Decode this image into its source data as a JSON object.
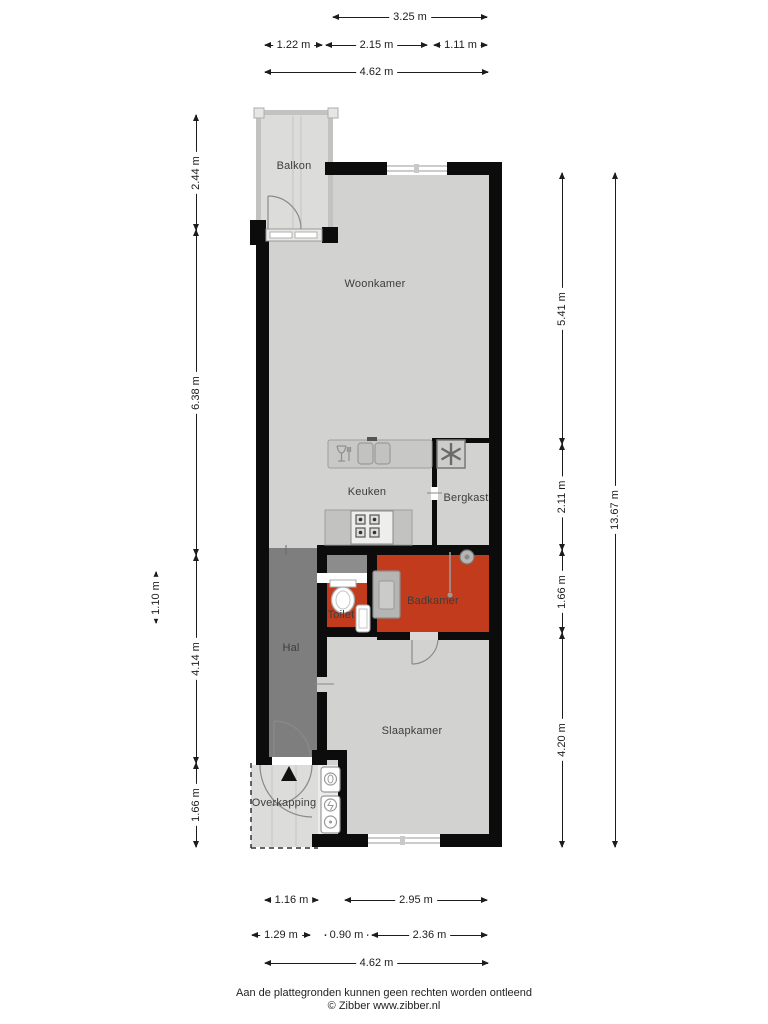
{
  "floorplan": {
    "colors": {
      "wall": "#0c0c0c",
      "floor_indoor": "#d2d2d0",
      "floor_outdoor": "#dcdcda",
      "floor_hall": "#7e7e7e",
      "floor_wet_room": "#c33b1d",
      "counter": "#c8c8c6"
    },
    "rooms": [
      {
        "id": "balkon",
        "label": "Balkon",
        "cx": 294,
        "cy": 166
      },
      {
        "id": "woonkamer",
        "label": "Woonkamer",
        "cx": 375,
        "cy": 284
      },
      {
        "id": "keuken",
        "label": "Keuken",
        "cx": 367,
        "cy": 492
      },
      {
        "id": "bergkast",
        "label": "Bergkast",
        "cx": 466,
        "cy": 498
      },
      {
        "id": "toilet",
        "label": "Toilet",
        "cx": 341,
        "cy": 615
      },
      {
        "id": "badkamer",
        "label": "Badkamer",
        "cx": 433,
        "cy": 601
      },
      {
        "id": "hal",
        "label": "Hal",
        "cx": 291,
        "cy": 648
      },
      {
        "id": "slaapkamer",
        "label": "Slaapkamer",
        "cx": 412,
        "cy": 731
      },
      {
        "id": "overkapping",
        "label": "Overkapping",
        "cx": 284,
        "cy": 803
      }
    ],
    "dimensions": [
      {
        "label": "3.25 m",
        "dir": "h",
        "x": 333,
        "y": 12,
        "len": 154
      },
      {
        "label": "1.22 m",
        "dir": "h",
        "x": 265,
        "y": 40,
        "len": 57
      },
      {
        "label": "2.15 m",
        "dir": "h",
        "x": 326,
        "y": 40,
        "len": 101
      },
      {
        "label": "1.11 m",
        "dir": "h",
        "x": 434,
        "y": 40,
        "len": 53
      },
      {
        "label": "4.62 m",
        "dir": "h",
        "x": 265,
        "y": 67,
        "len": 223
      },
      {
        "label": "1.16 m",
        "dir": "h",
        "x": 265,
        "y": 895,
        "len": 53
      },
      {
        "label": "2.95 m",
        "dir": "h",
        "x": 345,
        "y": 895,
        "len": 142
      },
      {
        "label": "1.29 m",
        "dir": "h",
        "x": 252,
        "y": 930,
        "len": 58
      },
      {
        "label": "0.90 m",
        "dir": "h",
        "x": 325,
        "y": 930,
        "len": 43
      },
      {
        "label": "2.36 m",
        "dir": "h",
        "x": 372,
        "y": 930,
        "len": 115
      },
      {
        "label": "4.62 m",
        "dir": "h",
        "x": 265,
        "y": 958,
        "len": 223
      },
      {
        "label": "1.10 m",
        "dir": "v",
        "x": 151,
        "y": 572,
        "len": 51
      },
      {
        "label": "2.44 m",
        "dir": "v",
        "x": 191,
        "y": 115,
        "len": 115
      },
      {
        "label": "6.38 m",
        "dir": "v",
        "x": 191,
        "y": 230,
        "len": 325
      },
      {
        "label": "4.14 m",
        "dir": "v",
        "x": 191,
        "y": 555,
        "len": 208
      },
      {
        "label": "1.66 m",
        "dir": "v",
        "x": 191,
        "y": 763,
        "len": 84
      },
      {
        "label": "5.41 m",
        "dir": "v",
        "x": 557,
        "y": 173,
        "len": 271
      },
      {
        "label": "2.11 m",
        "dir": "v",
        "x": 557,
        "y": 444,
        "len": 106
      },
      {
        "label": "1.66 m",
        "dir": "v",
        "x": 557,
        "y": 550,
        "len": 83
      },
      {
        "label": "4.20 m",
        "dir": "v",
        "x": 557,
        "y": 633,
        "len": 214
      },
      {
        "label": "13.67 m",
        "dir": "v",
        "x": 610,
        "y": 173,
        "len": 674
      }
    ]
  },
  "footer": {
    "disclaimer": "Aan de plattegronden kunnen geen rechten worden ontleend",
    "copyright": "© Zibber www.zibber.nl"
  }
}
